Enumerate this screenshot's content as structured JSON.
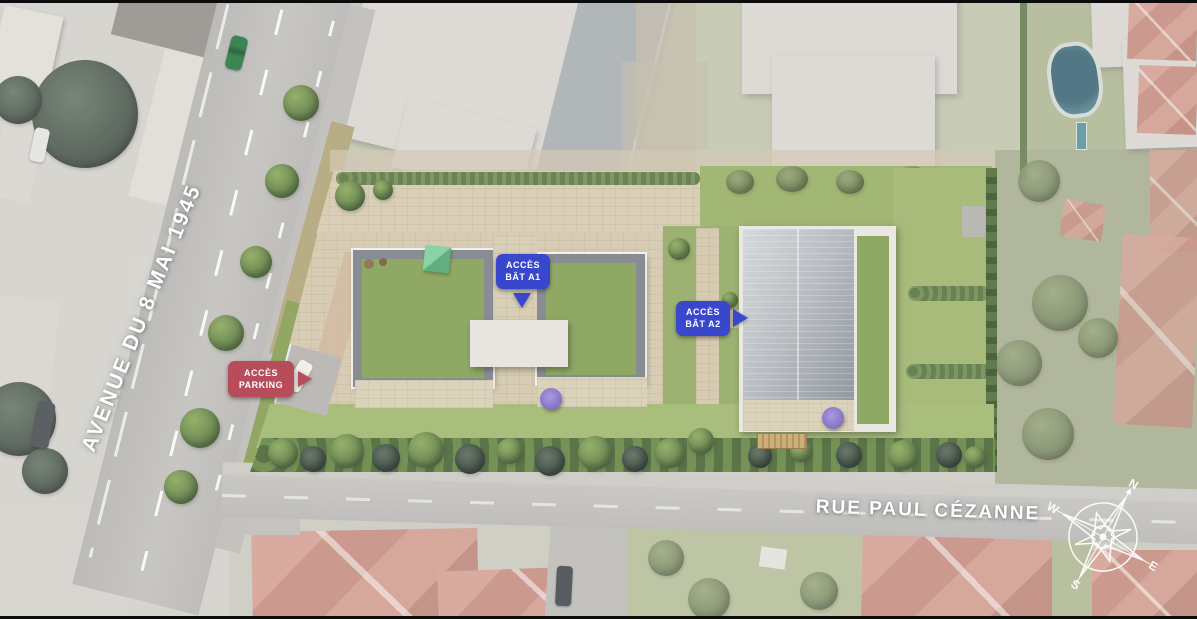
{
  "streets": {
    "avenue_label": "AVENUE DU 8 MAI 1945",
    "rue_label": "RUE PAUL CÉZANNE"
  },
  "badges": {
    "parking": {
      "line1": "ACCÈS",
      "line2": "PARKING",
      "color": "#b23f4e",
      "arrow": "right"
    },
    "bat_a1": {
      "line1": "ACCÈS",
      "line2": "BÂT A1",
      "color": "#2b3ac9",
      "arrow": "down"
    },
    "bat_a2": {
      "line1": "ACCÈS",
      "line2": "BÂT A2",
      "color": "#2b3ac9",
      "arrow": "right"
    }
  },
  "compass": {
    "n": "N",
    "e": "E",
    "s": "S",
    "w": "W"
  },
  "colors": {
    "badge_red": "#b23f4e",
    "badge_blue": "#2b3ac9",
    "label_text": "#ffffff",
    "road_gray": "#bdbbb8",
    "site_path_beige": "#d7ccb2",
    "lawn_green": "#9cb26b",
    "green_roof": "#8aa55c",
    "metal_roof": "#9aa1a7",
    "tile_roof": "#cf9184"
  }
}
